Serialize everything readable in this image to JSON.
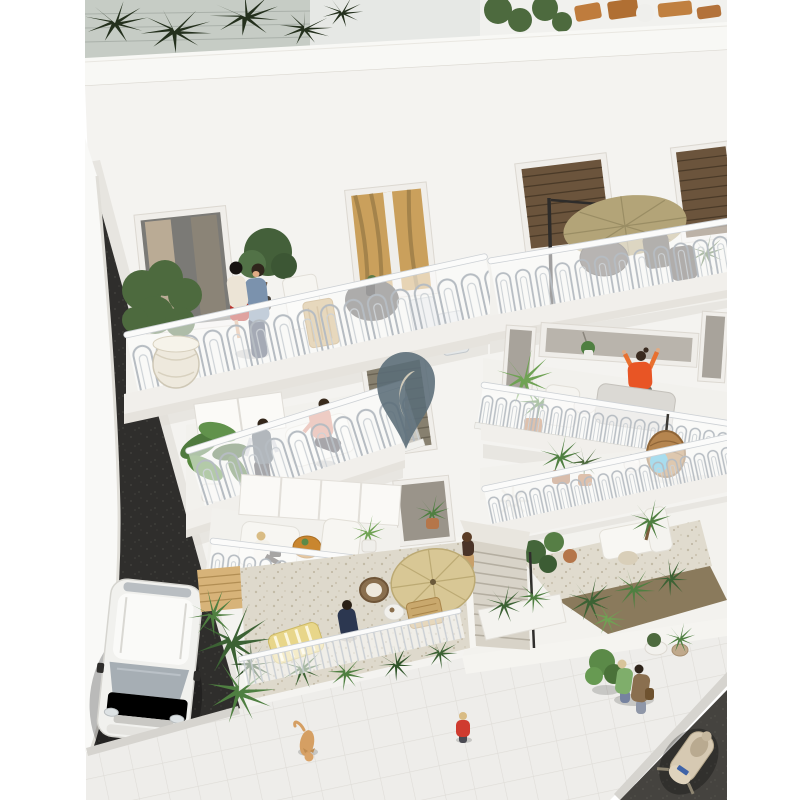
{
  "scene": {
    "alt": "Aerial 3D architectural rendering of a white residential building with ornate balconies, roof terrace plants, residents on balconies, ground-floor gravel gardens, a staircase, tiled sidewalk with pedestrians, a parked white van and a scooter",
    "watermark_icon": "location-pin-crescent-icon"
  },
  "colors": {
    "facade": "#f4f3f0",
    "parapet": "#f8f8f5",
    "neighbor_wall": "#f9f9f7",
    "road": "#2f2e2c",
    "asphalt": "#45433f",
    "sidewalk": "#eeedea",
    "curb": "#d6d4cf",
    "stairs": "#d8d3c8",
    "gravel_left": "#ded9cc",
    "gravel_right": "#e0dbce",
    "soil": "#8a7a5c",
    "wood_fence": "#d7b379",
    "deck_wood": "#c9a86d",
    "umbrella_cream": "#d8c795",
    "umbrella_tan": "#b3a478",
    "table_orange": "#c9862f",
    "lounger_yellow": "#e8d68a",
    "rattan": "#8a6f4e",
    "egg_chair": "#b5854f",
    "cushion_blue": "#3fb3d9",
    "sofa_white": "#f7f6f2",
    "sofa_gray": "#dbd9d4",
    "palm_dark": "#3c6234",
    "palm_mid": "#4f7f41",
    "palm_bright": "#6fa254",
    "roof_plant": "#24301d",
    "foliage": "#4d6a3e",
    "van_body": "#f1f1ee",
    "van_glass": "#a6aeb4",
    "scooter_body": "#d6c9b2",
    "cat_fur": "#d59f63",
    "skin": "#e0ab85",
    "shirt_denim": "#7b92ad",
    "jeans_navy": "#39445c",
    "top_cream": "#ece4d6",
    "skirt_red": "#b8322c",
    "shirt_salmon": "#d98f7c",
    "vest_slate": "#55606b",
    "top_orange": "#e85525",
    "person_navy": "#2c3750",
    "top_green": "#7fae6b",
    "top_tan": "#8a6f4f",
    "kid_red": "#cf3b2f",
    "stairs_dress_top": "#4a3428",
    "stairs_dress_skirt": "#c8a06a",
    "door_curtain": "#caa05c",
    "shutter_brown": "#6b543c",
    "window_glass": "#b9b4ac",
    "dark_window": "#6e6962",
    "pin_fill": "#5a6c78",
    "pin_crescent": "#d9d0bd"
  }
}
